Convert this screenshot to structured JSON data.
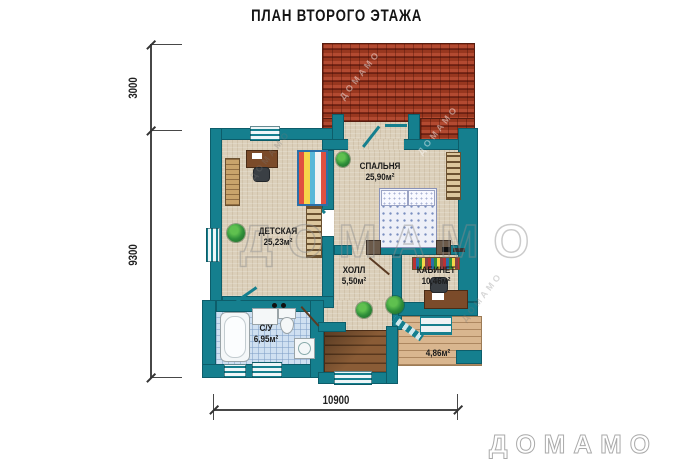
{
  "title": "ПЛАН ВТОРОГО ЭТАЖА",
  "dimensions": {
    "left_top": "3000",
    "left_bottom": "9300",
    "bottom": "10900"
  },
  "rooms": [
    {
      "id": "bedroom",
      "name": "СПАЛЬНЯ",
      "area": "25,90м²"
    },
    {
      "id": "kids",
      "name": "ДЕТСКАЯ",
      "area": "25,23м²"
    },
    {
      "id": "hall",
      "name": "ХОЛЛ",
      "area": "5,50м²"
    },
    {
      "id": "office",
      "name": "КАБИНЕТ",
      "area": "10,46м²"
    },
    {
      "id": "bathroom",
      "name": "С/У",
      "area": "6,95м²"
    },
    {
      "id": "balcony",
      "name": "",
      "area": "4,86м²"
    }
  ],
  "watermark": {
    "center": "ДОМАМО",
    "corner": "ДОМАМО"
  },
  "colors": {
    "wall": "#157f8e",
    "floor": "#dbcfba",
    "roof": "#a43f2a",
    "tile": "#cfe0f1",
    "deck": "#d9b68f"
  }
}
